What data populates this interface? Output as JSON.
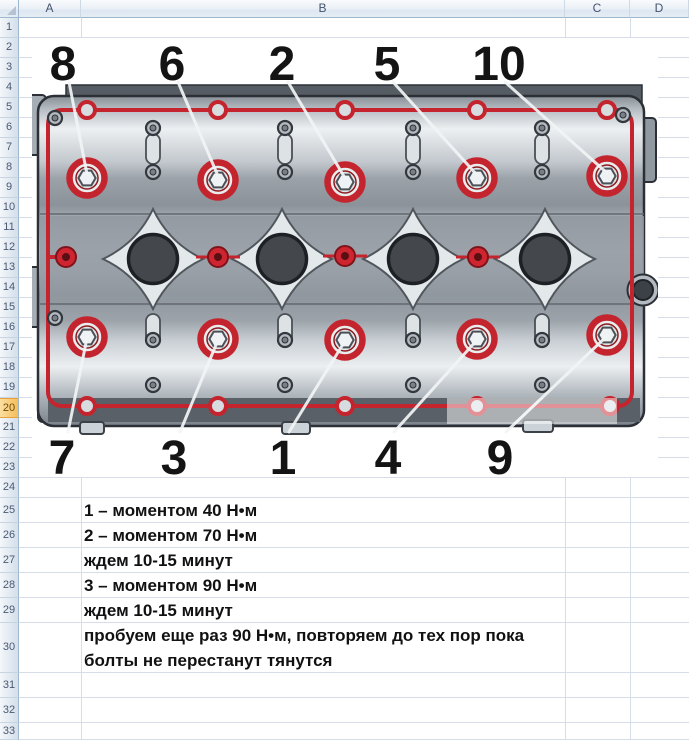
{
  "spreadsheet": {
    "columns": [
      "A",
      "B",
      "C",
      "D"
    ],
    "row_numbers": [
      "1",
      "2",
      "3",
      "4",
      "5",
      "6",
      "7",
      "8",
      "9",
      "10",
      "11",
      "12",
      "13",
      "14",
      "15",
      "16",
      "17",
      "18",
      "19",
      "20",
      "21",
      "22",
      "23",
      "24",
      "25",
      "26",
      "27",
      "28",
      "29",
      "30",
      "31",
      "32",
      "33"
    ],
    "selected_row": "20"
  },
  "diagram": {
    "top_sequence": [
      "8",
      "6",
      "2",
      "5",
      "10"
    ],
    "bottom_sequence": [
      "7",
      "3",
      "1",
      "4",
      "9"
    ],
    "colors": {
      "gasket_red": "#c4242d",
      "dark_red": "#8e1a1f",
      "metal_light": "#eef1f3",
      "metal_dark": "#565c63",
      "bore_dark": "#44484d"
    }
  },
  "notes": {
    "lines": [
      "1 – моментом 40 Н•м",
      "2 – моментом 70 Н•м",
      "ждем 10-15 минут",
      "3 – моментом 90 Н•м",
      "ждем 10-15 минут",
      "пробуем еще раз 90 Н•м, повторяем до тех пор пока болты не перестанут тянутся"
    ]
  }
}
